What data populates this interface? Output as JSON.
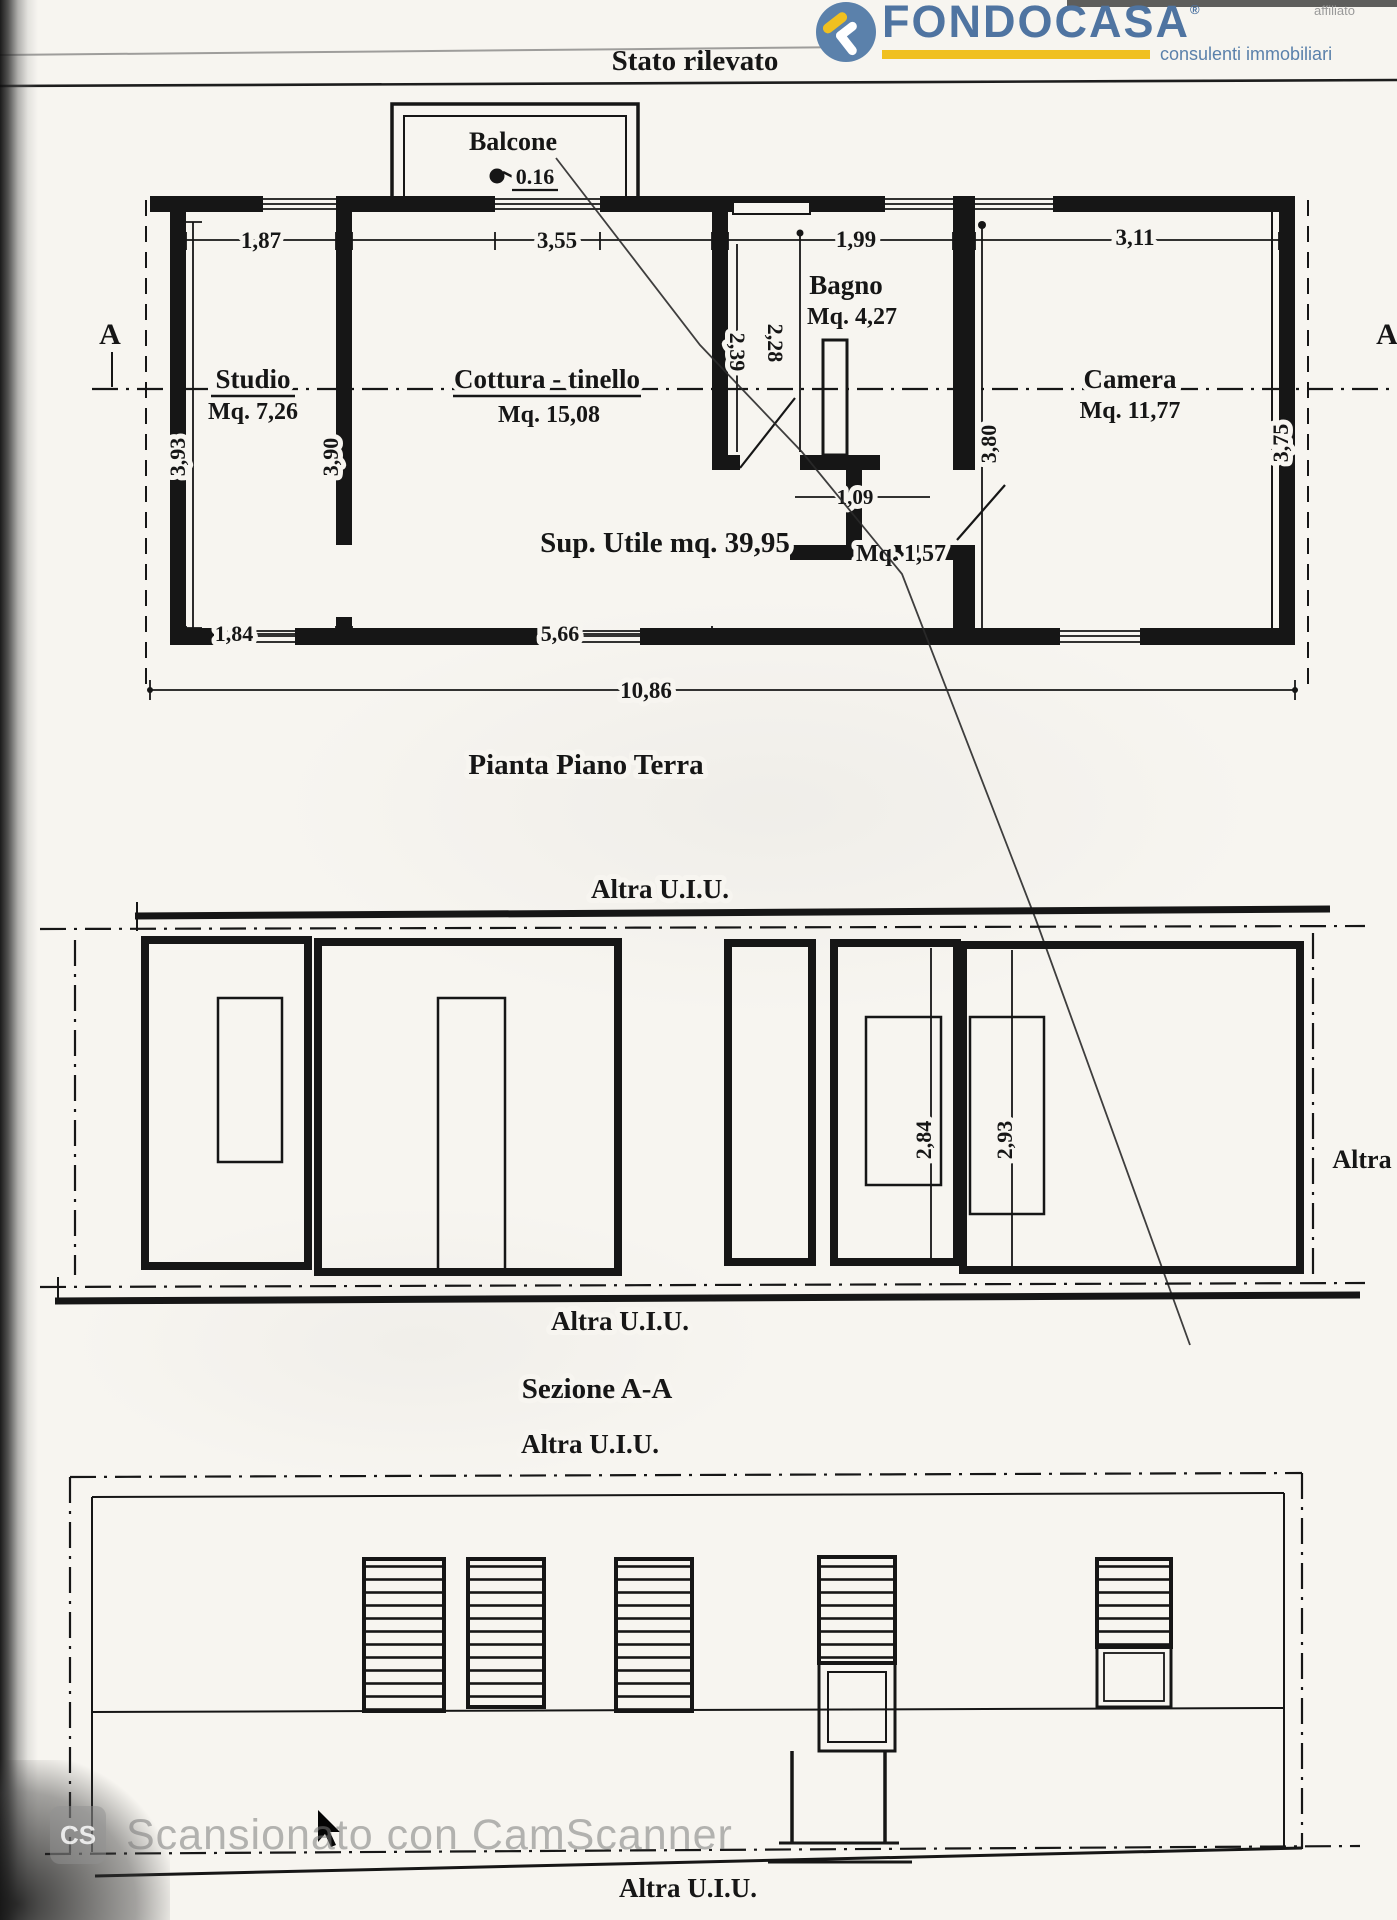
{
  "header": {
    "title": "Stato rilevato"
  },
  "logo": {
    "brand": "FONDOCASA",
    "registered": "®",
    "affiliate": "affiliato",
    "tagline": "consulenti immobiliari",
    "brand_color": "#4f74a1",
    "accent_color": "#f0c020",
    "badge_color": "#5b81ab"
  },
  "plan": {
    "title": "Pianta Piano Terra",
    "summary": "Sup. Utile mq. 39,95",
    "section_marker": "A",
    "balcony": {
      "label": "Balcone",
      "value": "0.16"
    },
    "rooms": {
      "studio": {
        "name": "Studio",
        "area": "Mq. 7,26"
      },
      "cottura": {
        "name": "Cottura - tinello",
        "area": "Mq. 15,08"
      },
      "bagno": {
        "name": "Bagno",
        "area": "Mq. 4,27"
      },
      "camera": {
        "name": "Camera",
        "area": "Mq. 11,77"
      },
      "disimpegno": {
        "area": "Mq. 1,57"
      }
    },
    "dims": {
      "w_studio": "1,87",
      "w_cottura": "3,55",
      "w_bagno": "1,99",
      "w_camera": "3,11",
      "h_studio": "3,93",
      "h_cottura": "3,90",
      "h_bagno_1": "2,39",
      "h_bagno_2": "2,28",
      "h_camera": "3,80",
      "h_camera_r": "3,75",
      "w_studio_win": "1,84",
      "w_cottura_b": "5,66",
      "w_disimpegno": "1,09",
      "w_total": "10,86"
    }
  },
  "section": {
    "title": "Sezione A-A",
    "label_above": "Altra U.I.U.",
    "label_below": "Altra U.I.U.",
    "label_right": "Altra",
    "dims": {
      "h_left": "2,84",
      "h_right": "2,93"
    }
  },
  "elevation": {
    "label_above": "Altra U.I.U.",
    "label_below": "Altra U.I.U."
  },
  "watermark": {
    "logo_text": "CS",
    "text": "Scansionato con CamScanner"
  }
}
